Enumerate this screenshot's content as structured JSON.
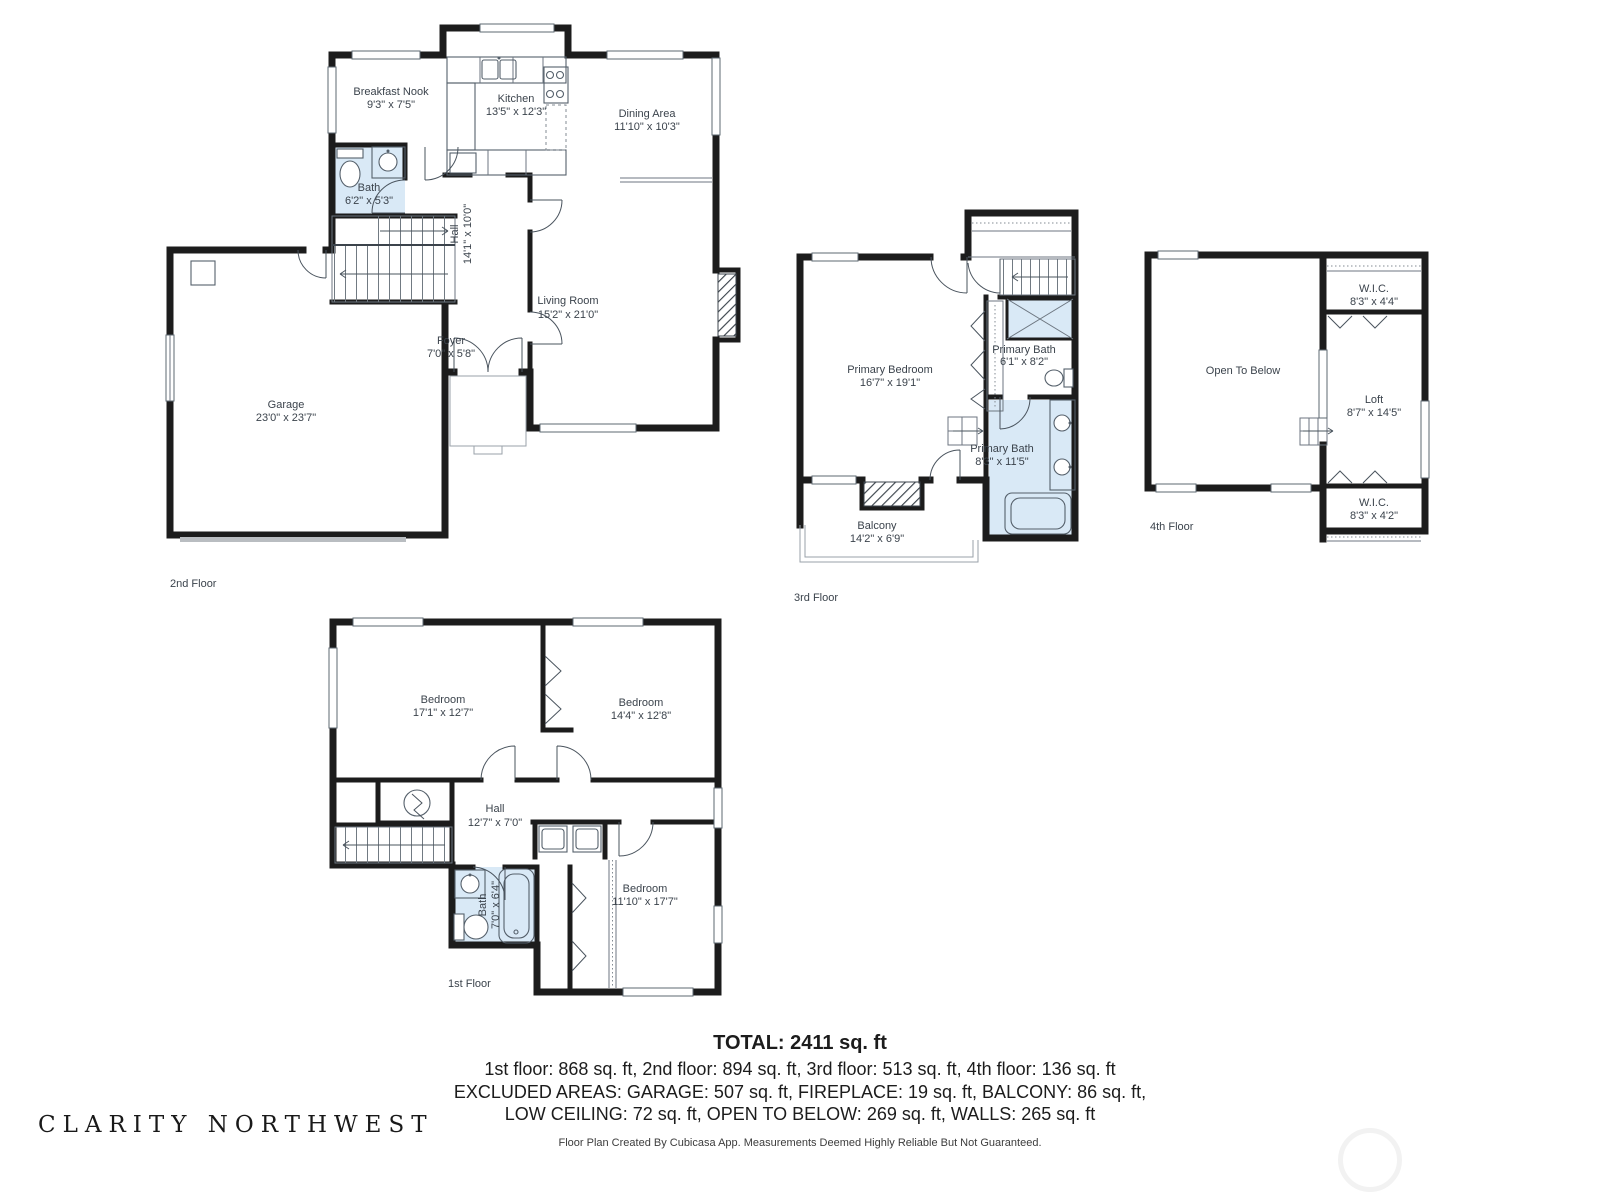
{
  "floors": {
    "f1": {
      "label": "1st Floor",
      "rooms": {
        "bedroom_a": {
          "name": "Bedroom",
          "dims": "17'1\" x 12'7\""
        },
        "bedroom_b": {
          "name": "Bedroom",
          "dims": "14'4\" x 12'8\""
        },
        "hall": {
          "name": "Hall",
          "dims": "12'7\" x 7'0\""
        },
        "bath": {
          "name": "Bath",
          "dims": "7'0\" x 6'4\""
        },
        "bedroom_c": {
          "name": "Bedroom",
          "dims": "11'10\" x 17'7\""
        }
      }
    },
    "f2": {
      "label": "2nd Floor",
      "rooms": {
        "breakfast": {
          "name": "Breakfast Nook",
          "dims": "9'3\" x 7'5\""
        },
        "kitchen": {
          "name": "Kitchen",
          "dims": "13'5\" x 12'3\""
        },
        "dining": {
          "name": "Dining Area",
          "dims": "11'10\" x 10'3\""
        },
        "bath": {
          "name": "Bath",
          "dims": "6'2\" x 5'3\""
        },
        "hall": {
          "name": "Hall",
          "dims": "14'1\" x 10'0\""
        },
        "living": {
          "name": "Living Room",
          "dims": "15'2\" x 21'0\""
        },
        "foyer": {
          "name": "Foyer",
          "dims": "7'0\" x 5'8\""
        },
        "garage": {
          "name": "Garage",
          "dims": "23'0\" x 23'7\""
        }
      }
    },
    "f3": {
      "label": "3rd Floor",
      "rooms": {
        "primary_bedroom": {
          "name": "Primary Bedroom",
          "dims": "16'7\" x 19'1\""
        },
        "primary_bath_upper": {
          "name": "Primary Bath",
          "dims": "6'1\" x 8'2\""
        },
        "primary_bath_lower": {
          "name": "Primary Bath",
          "dims": "8'3\" x 11'5\""
        },
        "balcony": {
          "name": "Balcony",
          "dims": "14'2\" x 6'9\""
        }
      }
    },
    "f4": {
      "label": "4th Floor",
      "rooms": {
        "open_to_below": {
          "name": "Open To Below"
        },
        "wic_upper": {
          "name": "W.I.C.",
          "dims": "8'3\" x 4'4\""
        },
        "loft": {
          "name": "Loft",
          "dims": "8'7\" x 14'5\""
        },
        "wic_lower": {
          "name": "W.I.C.",
          "dims": "8'3\" x 4'2\""
        }
      }
    }
  },
  "summary": {
    "total": "TOTAL: 2411 sq. ft",
    "floors_line": "1st floor: 868 sq. ft, 2nd floor: 894 sq. ft, 3rd floor: 513 sq. ft, 4th floor: 136 sq. ft",
    "excluded_line1": "EXCLUDED AREAS: GARAGE: 507 sq. ft, FIREPLACE: 19 sq. ft, BALCONY: 86 sq. ft,",
    "excluded_line2": "LOW CEILING: 72 sq. ft, OPEN TO BELOW: 269 sq. ft, WALLS: 265 sq. ft"
  },
  "footer": {
    "disclaimer": "Floor Plan Created By Cubicasa App. Measurements Deemed Highly Reliable But Not Guaranteed.",
    "brand": "CLARITY NORTHWEST"
  },
  "colors": {
    "wall": "#1c1c1c",
    "bath_fill": "#d9e9f6",
    "label_text": "#3b434c",
    "summary_text": "#1c1c1c"
  }
}
